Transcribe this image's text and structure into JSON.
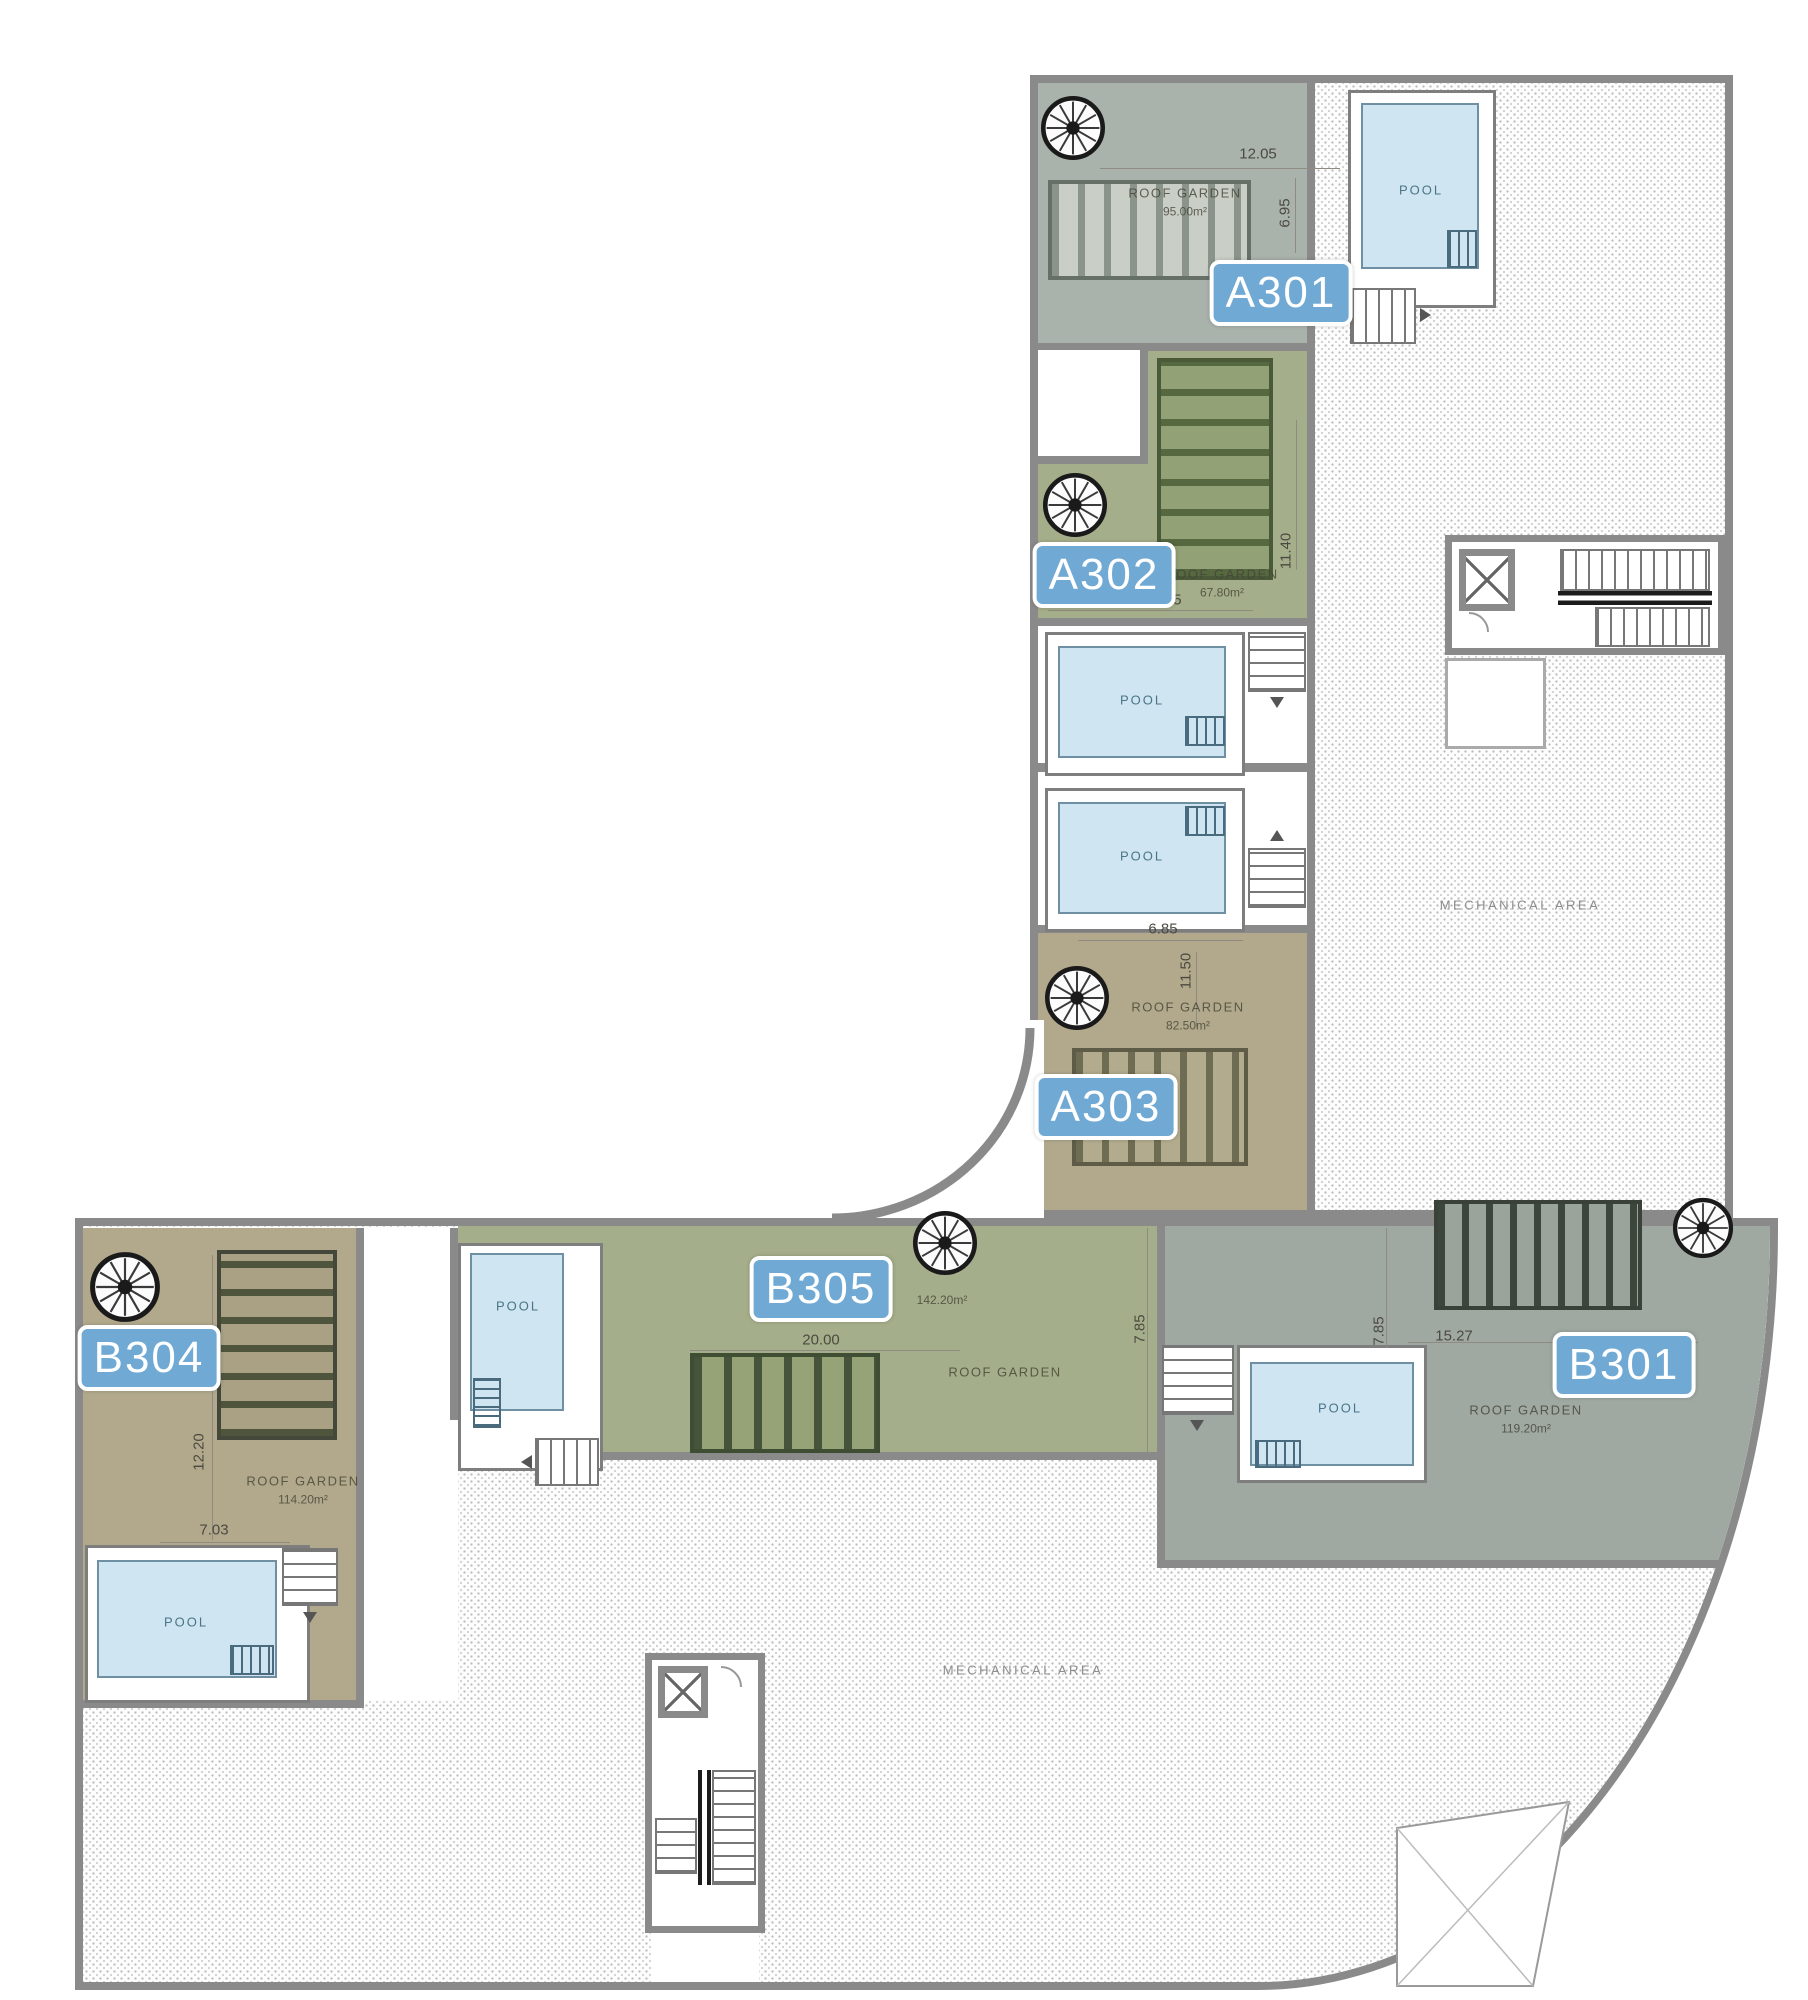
{
  "title": "Roof floor plan",
  "labels": {
    "roof_garden": "ROOF GARDEN",
    "pool": "POOL",
    "mechanical": "MECHANICAL AREA"
  },
  "units": {
    "a301": {
      "label": "A301",
      "area": "95.00m²",
      "dims": {
        "top": "12.05",
        "right": "6.95"
      }
    },
    "a302": {
      "label": "A302",
      "area": "67.80m²",
      "dims": {
        "bottom": "5.85",
        "right": "11.40"
      }
    },
    "a303": {
      "label": "A303",
      "area": "82.50m²",
      "dims": {
        "top": "6.85",
        "left": "11.50"
      }
    },
    "b301": {
      "label": "B301",
      "area": "119.20m²",
      "dims": {
        "top": "15.27",
        "left": "7.85"
      }
    },
    "b304": {
      "label": "B304",
      "area": "114.20m²",
      "dims": {
        "left": "12.20",
        "bottom": "7.03"
      }
    },
    "b305": {
      "label": "B305",
      "area": "142.20m²",
      "dims": {
        "top": "20.00",
        "right": "7.85"
      }
    }
  },
  "colors": {
    "unit_badge": "#70a9d4",
    "garden_gray_green": "#a9b2ab",
    "garden_green": "#a5ae8a",
    "garden_tan": "#b2a98c",
    "garden_b301": "#9fa9a2",
    "pool_water": "#cfe6f2",
    "wall": "#8a8a8a"
  }
}
